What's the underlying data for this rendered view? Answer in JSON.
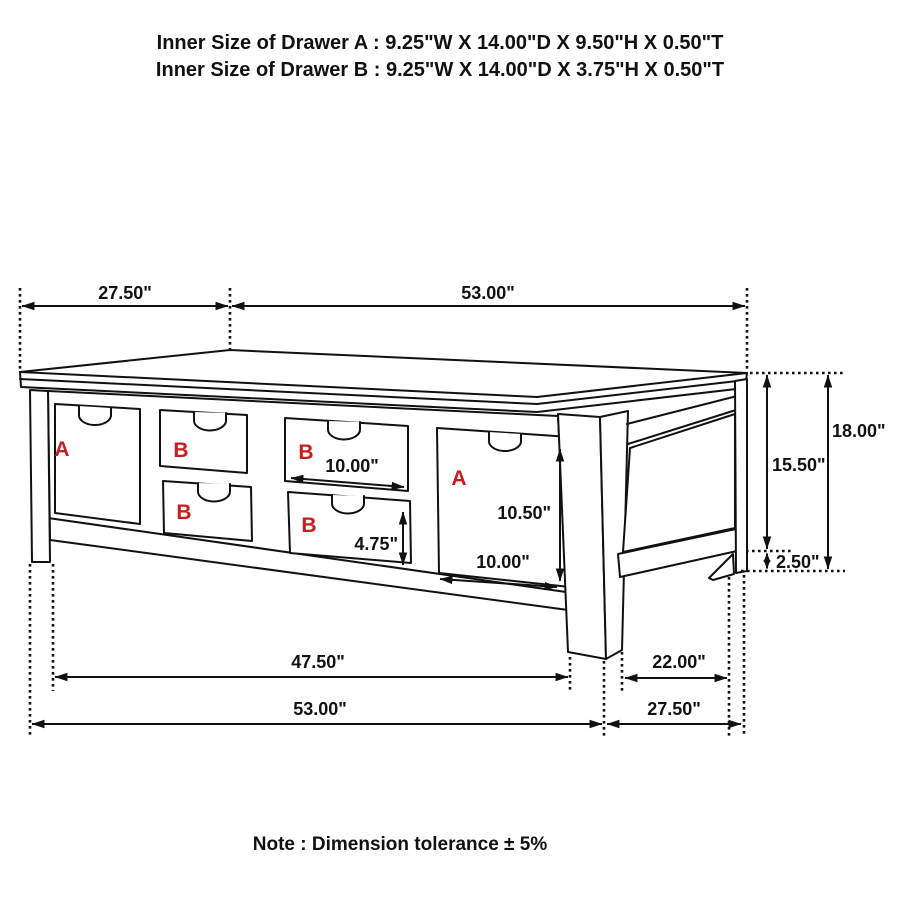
{
  "header": {
    "line_a": "Inner Size of Drawer A : 9.25\"W X 14.00\"D X 9.50\"H X 0.50\"T",
    "line_b": "Inner Size of Drawer B : 9.25\"W X 14.00\"D X 3.75\"H X 0.50\"T"
  },
  "note": "Note : Dimension tolerance ± 5%",
  "dimensions": {
    "top_overhang_left": "27.50\"",
    "top_length": "53.00\"",
    "height_total": "18.00\"",
    "height_upper": "15.50\"",
    "foot_height": "2.50\"",
    "inner_b_width": "10.00\"",
    "inner_b_height": "4.75\"",
    "inner_a_height": "10.50\"",
    "inner_a_width": "10.00\"",
    "bottom_front_span": "47.50\"",
    "bottom_right_span": "22.00\"",
    "bottom_length": "53.00\"",
    "bottom_depth": "27.50\""
  },
  "drawer_letters": [
    "A",
    "B",
    "B",
    "B",
    "B",
    "A"
  ],
  "colors": {
    "line": "#111111",
    "drawer_letter_red": "#c41e1e",
    "background": "#ffffff"
  }
}
